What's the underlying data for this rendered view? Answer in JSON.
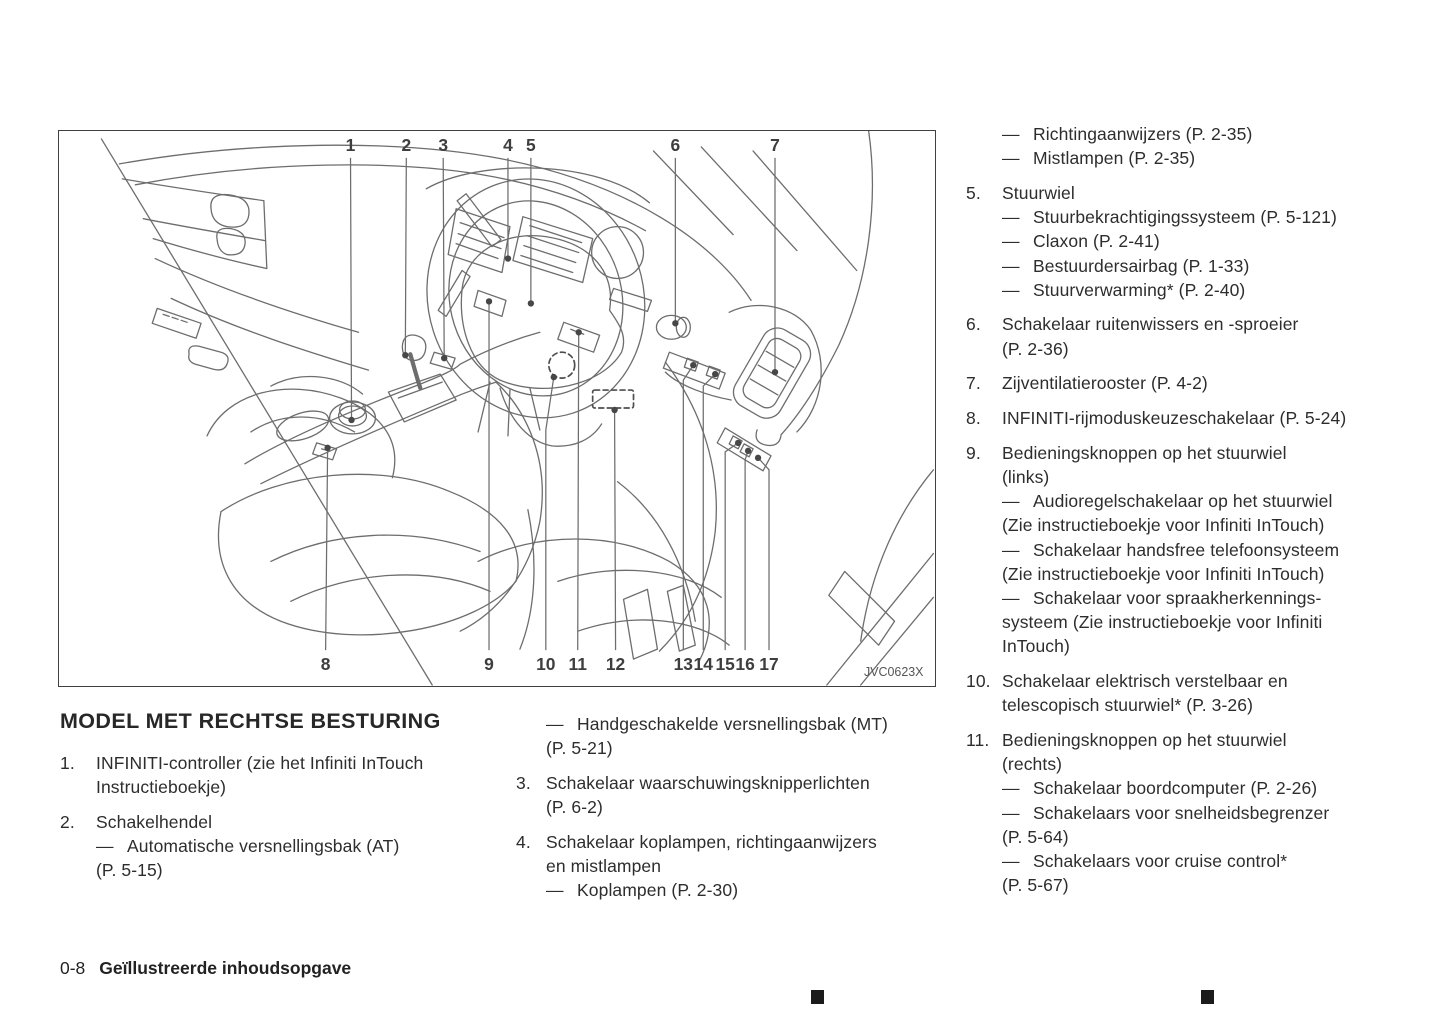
{
  "heading": "MODEL MET RECHTSE BESTURING",
  "footer": {
    "page_number": "0-8",
    "section_title": "Geïllustreerde inhoudsopgave"
  },
  "colors": {
    "text": "#2d2d2d",
    "diagram_line": "#6d6d6d",
    "border": "#414141"
  },
  "figure": {
    "code": "JVC0623X",
    "callouts": [
      {
        "label": "1",
        "side": "top",
        "lx": 292,
        "ex": 293,
        "ey": 290
      },
      {
        "label": "2",
        "side": "top",
        "lx": 348,
        "ex": 347,
        "ey": 225
      },
      {
        "label": "3",
        "side": "top",
        "lx": 385,
        "ex": 386,
        "ey": 228
      },
      {
        "label": "4",
        "side": "top",
        "lx": 450,
        "ex": 450,
        "ey": 128
      },
      {
        "label": "5",
        "side": "top",
        "lx": 473,
        "ex": 473,
        "ey": 173
      },
      {
        "label": "6",
        "side": "top",
        "lx": 618,
        "ex": 618,
        "ey": 193
      },
      {
        "label": "7",
        "side": "top",
        "lx": 718,
        "ex": 718,
        "ey": 242
      },
      {
        "label": "8",
        "side": "bottom",
        "lx": 267,
        "ex": 269,
        "ey": 318
      },
      {
        "label": "9",
        "side": "bottom",
        "lx": 431,
        "ex": 431,
        "ey": 171
      },
      {
        "label": "10",
        "side": "bottom",
        "lx": 488,
        "bend": [
          488,
          300
        ],
        "ex": 496,
        "ey": 247
      },
      {
        "label": "11",
        "side": "bottom",
        "lx": 520,
        "ex": 521,
        "ey": 202
      },
      {
        "label": "12",
        "side": "bottom",
        "lx": 558,
        "ex": 557,
        "ey": 280
      },
      {
        "label": "13",
        "side": "bottom",
        "lx": 626,
        "bend": [
          626,
          250
        ],
        "ex": 636,
        "ey": 235
      },
      {
        "label": "14",
        "side": "bottom",
        "lx": 646,
        "bend": [
          646,
          256
        ],
        "ex": 658,
        "ey": 244
      },
      {
        "label": "15",
        "side": "bottom",
        "lx": 668,
        "bend": [
          668,
          322
        ],
        "ex": 681,
        "ey": 313
      },
      {
        "label": "16",
        "side": "bottom",
        "lx": 688,
        "bend": [
          688,
          330
        ],
        "ex": 691,
        "ey": 321
      },
      {
        "label": "17",
        "side": "bottom",
        "lx": 712,
        "bend": [
          712,
          340
        ],
        "ex": 701,
        "ey": 328
      }
    ]
  },
  "columns": {
    "left": [
      {
        "n": "1.",
        "lines": [
          {
            "d": 0,
            "t": "INFINITI-controller (zie het Infiniti InTouch"
          },
          {
            "d": 0,
            "t": "Instructieboekje)"
          }
        ]
      },
      {
        "n": "2.",
        "lines": [
          {
            "d": 0,
            "t": "Schakelhendel"
          },
          {
            "d": 1,
            "t": "Automatische versnellingsbak (AT)"
          },
          {
            "d": 0,
            "t": "(P. 5-15)"
          }
        ]
      }
    ],
    "middle": [
      {
        "n": "",
        "lines": [
          {
            "d": 1,
            "t": "Handgeschakelde versnellingsbak (MT)"
          },
          {
            "d": 0,
            "t": "(P. 5-21)"
          }
        ]
      },
      {
        "n": "3.",
        "lines": [
          {
            "d": 0,
            "t": "Schakelaar waarschuwingsknipperlichten"
          },
          {
            "d": 0,
            "t": "(P. 6-2)"
          }
        ]
      },
      {
        "n": "4.",
        "lines": [
          {
            "d": 0,
            "t": "Schakelaar koplampen, richtingaanwijzers"
          },
          {
            "d": 0,
            "t": "en mistlampen"
          },
          {
            "d": 1,
            "t": "Koplampen (P. 2-30)"
          }
        ]
      }
    ],
    "right": [
      {
        "n": "",
        "lines": [
          {
            "d": 1,
            "t": "Richtingaanwijzers (P. 2-35)"
          },
          {
            "d": 1,
            "t": "Mistlampen (P. 2-35)"
          }
        ]
      },
      {
        "n": "5.",
        "lines": [
          {
            "d": 0,
            "t": "Stuurwiel"
          },
          {
            "d": 1,
            "t": "Stuurbekrachtigingssysteem (P. 5-121)"
          },
          {
            "d": 1,
            "t": "Claxon (P. 2-41)"
          },
          {
            "d": 1,
            "t": "Bestuurdersairbag (P. 1-33)"
          },
          {
            "d": 1,
            "t": "Stuurverwarming* (P. 2-40)"
          }
        ]
      },
      {
        "n": "6.",
        "lines": [
          {
            "d": 0,
            "t": "Schakelaar ruitenwissers en -sproeier"
          },
          {
            "d": 0,
            "t": "(P. 2-36)"
          }
        ]
      },
      {
        "n": "7.",
        "lines": [
          {
            "d": 0,
            "t": "Zijventilatierooster (P. 4-2)"
          }
        ]
      },
      {
        "n": "8.",
        "lines": [
          {
            "d": 0,
            "t": "INFINITI-rijmoduskeuzeschakelaar (P. 5-24)"
          }
        ]
      },
      {
        "n": "9.",
        "lines": [
          {
            "d": 0,
            "t": "Bedieningsknoppen op het stuurwiel"
          },
          {
            "d": 0,
            "t": "(links)"
          },
          {
            "d": 1,
            "t": "Audioregelschakelaar op het stuurwiel"
          },
          {
            "d": 0,
            "t": "(Zie instructieboekje voor Infiniti InTouch)"
          },
          {
            "d": 1,
            "t": "Schakelaar handsfree telefoonsysteem"
          },
          {
            "d": 0,
            "t": "(Zie instructieboekje voor Infiniti InTouch)"
          },
          {
            "d": 1,
            "t": "Schakelaar voor spraakherkennings-"
          },
          {
            "d": 0,
            "t": "systeem (Zie instructieboekje voor Infiniti"
          },
          {
            "d": 0,
            "t": "InTouch)"
          }
        ]
      },
      {
        "n": "10.",
        "lines": [
          {
            "d": 0,
            "t": "Schakelaar elektrisch verstelbaar en"
          },
          {
            "d": 0,
            "t": "telescopisch stuurwiel* (P. 3-26)"
          }
        ]
      },
      {
        "n": "11.",
        "lines": [
          {
            "d": 0,
            "t": "Bedieningsknoppen op het stuurwiel"
          },
          {
            "d": 0,
            "t": "(rechts)"
          },
          {
            "d": 1,
            "t": "Schakelaar boordcomputer (P. 2-26)"
          },
          {
            "d": 1,
            "t": "Schakelaars voor snelheidsbegrenzer"
          },
          {
            "d": 0,
            "t": "(P. 5-64)"
          },
          {
            "d": 1,
            "t": "Schakelaars voor cruise control*"
          },
          {
            "d": 0,
            "t": "(P. 5-67)"
          }
        ]
      }
    ]
  }
}
